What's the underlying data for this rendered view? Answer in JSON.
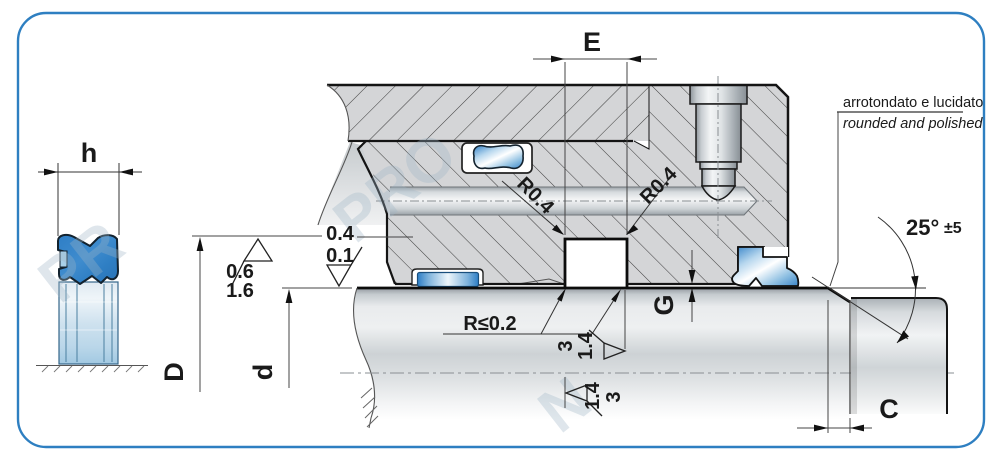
{
  "drawing": {
    "type": "seal-installation-technical-drawing",
    "border_color": "#2e7fc1",
    "seal_color": "#2f7fc4",
    "hatch_fill": "#d4d5d7"
  },
  "labels": {
    "h": "h",
    "E": "E",
    "D": "D",
    "d": "d",
    "G": "G",
    "C": "C",
    "angle": "25°",
    "angle_tol": "±5",
    "radius_left": "R0.4",
    "radius_right": "R0.4",
    "radius_max": "R≤0.2",
    "finish_bore_a": "0.6",
    "finish_bore_b": "1.6",
    "finish_groove_a": "0.4",
    "finish_groove_b": "0.1",
    "finish_shaft_upper_a": "3",
    "finish_shaft_upper_b": "1.4",
    "finish_shaft_lower_a": "1.4",
    "finish_shaft_lower_b": "3",
    "note_it": "arrotondato e lucidato",
    "note_en": "rounded and polished"
  },
  "watermark": [
    "PR",
    "PRO",
    "N"
  ]
}
